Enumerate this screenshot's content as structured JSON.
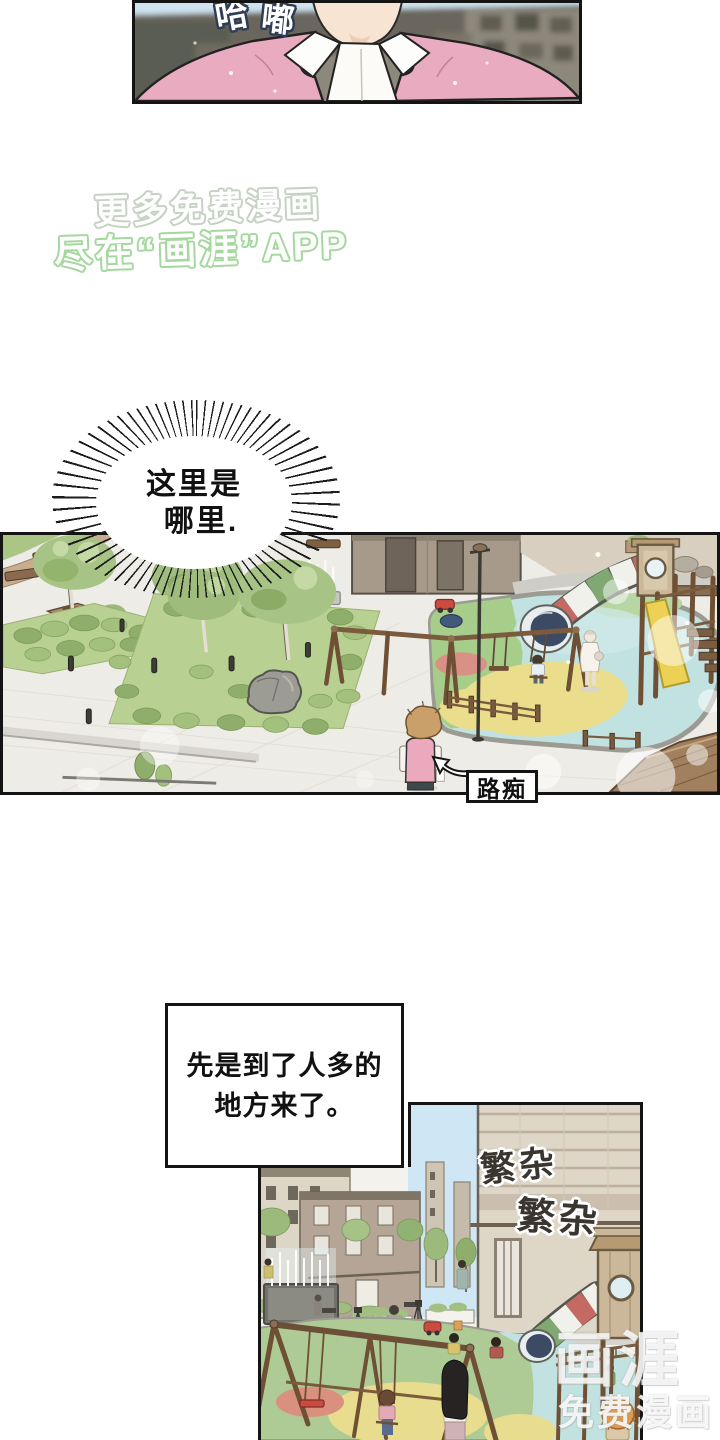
{
  "canvas": {
    "width": 720,
    "height": 1440,
    "background": "#ffffff"
  },
  "panel_top": {
    "sfx_char1": "哈",
    "sfx_char2": "嘟"
  },
  "promo_watermark": {
    "line1": "更多免费漫画",
    "line2": "尽在“画涯”APP"
  },
  "speech_bubble": {
    "line1": "这里是",
    "line2": "哪里."
  },
  "park_panel": {
    "caption": "路痴"
  },
  "narration": {
    "line1": "先是到了人多的",
    "line2": "地方来了。"
  },
  "city_panel": {
    "sfx_busy_1": "繁杂",
    "sfx_busy_2": "繁杂"
  },
  "brand": {
    "logo": "画涯",
    "tagline": "免费漫画"
  },
  "palette": {
    "ink": "#141414",
    "sweater_pink": "#e9abbf",
    "skin": "#f7e4d2",
    "lawn_green": "#b9d093",
    "bush_green": "#8fae6b",
    "canopy_green": "#a8c386",
    "playground_blue": "#c2e2e1",
    "patch_green": "#a7cd8b",
    "patch_yellow": "#eadd8c",
    "wood": "#7b5b3d",
    "slide_yellow": "#ecd154",
    "tube_red": "#c46a62",
    "tube_green": "#7fa873",
    "tube_mouth_navy": "#3c4b63",
    "sky": "#cfe6f4",
    "wall_beige": "#ded6c6",
    "promo_green": "#a5d89e",
    "sfx_ink": "#3a352f"
  }
}
